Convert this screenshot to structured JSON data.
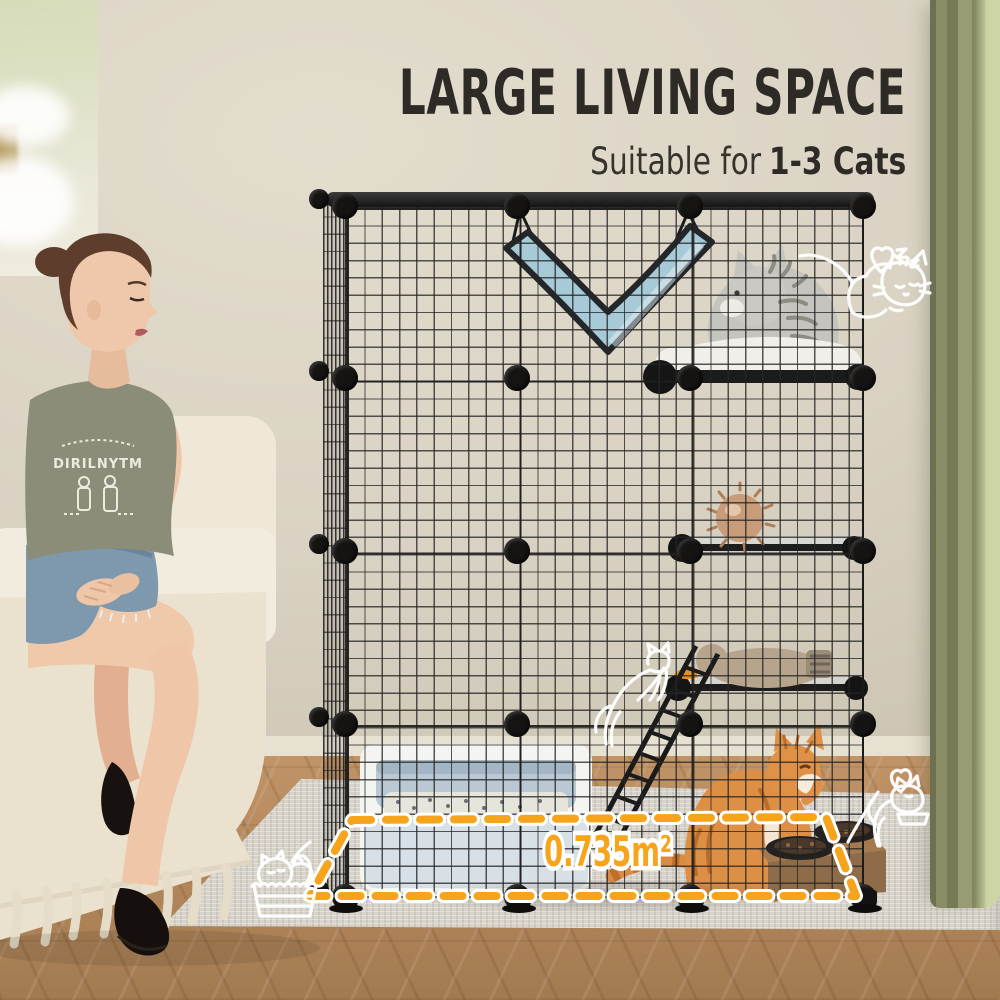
{
  "header": {
    "headline": "LARGE LIVING SPACE",
    "subtitle_light": "Suitable for",
    "subtitle_bold": "1-3 Cats"
  },
  "annotation": {
    "floor_area": "0.735m²"
  },
  "apparel": {
    "tshirt_text": "DIRILNYTM"
  },
  "palette": {
    "accent_orange": "#F7A41D",
    "headline_ink": "#2E2B27",
    "wall": "#DCD5C6",
    "curtain": "#8C8F6A",
    "wood_floor": "#B5895C",
    "rug": "#D8D4CB",
    "cage_wire": "#232323",
    "hammock": "#A7CAD8",
    "litter_box": "#C7D3DD",
    "cat_orange": "#DD8F46",
    "cat_gray": "#C6C4BE"
  },
  "icons": [
    {
      "name": "sleeping-cat-doodle"
    },
    {
      "name": "heart-icon"
    },
    {
      "name": "eating-cat-doodle"
    },
    {
      "name": "cats-in-basket-doodle"
    },
    {
      "name": "jumping-cat-doodle"
    }
  ]
}
